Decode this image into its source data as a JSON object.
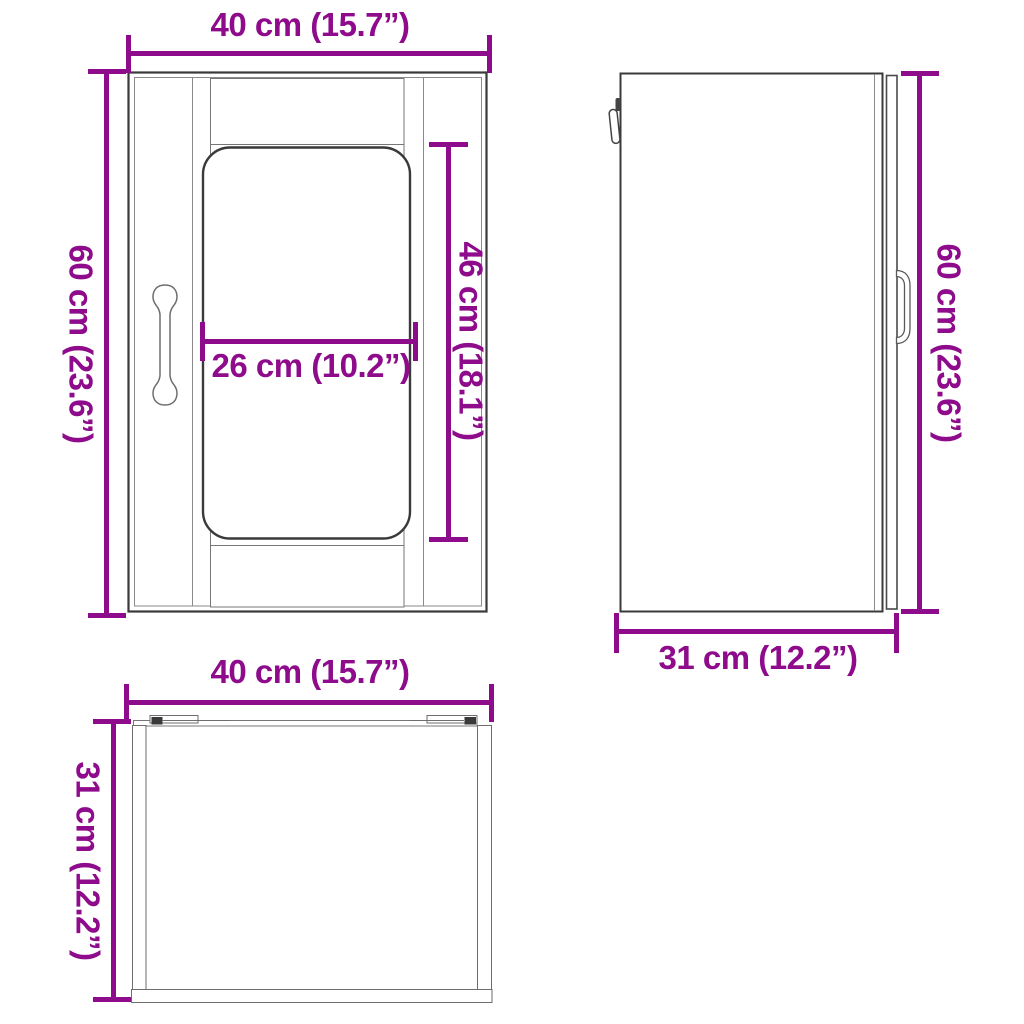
{
  "diagram": "wall-cabinet-three-view-dimension-drawing",
  "colors": {
    "dimension": "#8E0B8C",
    "outline_dark": "#3a3a3a",
    "outline_light": "#6e6e6e",
    "background": "#ffffff"
  },
  "views": {
    "front": {
      "name": "front view",
      "dimensions": {
        "width": {
          "label": "40 cm (15.7”)",
          "cm": 40,
          "inches": 15.7
        },
        "height": {
          "label": "60 cm (23.6”)",
          "cm": 60,
          "inches": 23.6
        },
        "glass_width": {
          "label": "26 cm (10.2”)",
          "cm": 26,
          "inches": 10.2
        },
        "glass_height": {
          "label": "46 cm (18.1”)",
          "cm": 46,
          "inches": 18.1
        }
      }
    },
    "side": {
      "name": "side view",
      "dimensions": {
        "height": {
          "label": "60 cm (23.6”)",
          "cm": 60,
          "inches": 23.6
        },
        "depth": {
          "label": "31 cm (12.2”)",
          "cm": 31,
          "inches": 12.2
        }
      }
    },
    "top": {
      "name": "bottom view",
      "dimensions": {
        "width": {
          "label": "40 cm (15.7”)",
          "cm": 40,
          "inches": 15.7
        },
        "depth": {
          "label": "31 cm (12.2”)",
          "cm": 31,
          "inches": 12.2
        }
      }
    }
  }
}
